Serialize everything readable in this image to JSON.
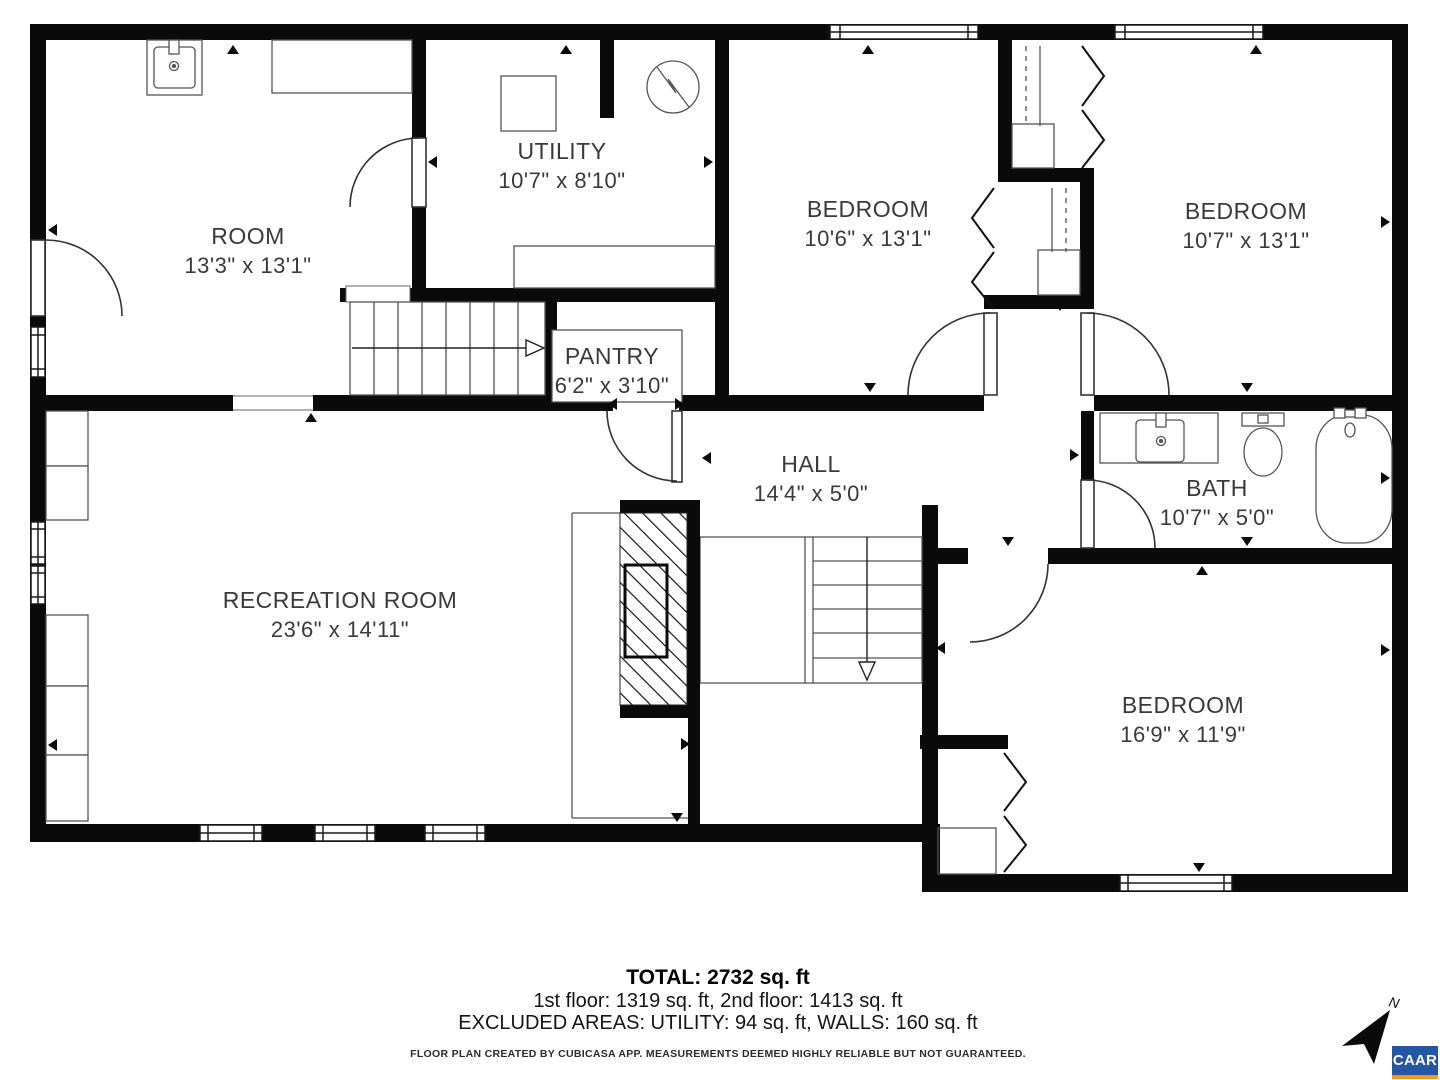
{
  "rooms": [
    {
      "name": "ROOM",
      "dims": "13'3\" x 13'1\""
    },
    {
      "name": "UTILITY",
      "dims": "10'7\" x 8'10\""
    },
    {
      "name": "BEDROOM",
      "dims": "10'6\" x 13'1\""
    },
    {
      "name": "BEDROOM",
      "dims": "10'7\" x 13'1\""
    },
    {
      "name": "PANTRY",
      "dims": "6'2\" x 3'10\""
    },
    {
      "name": "HALL",
      "dims": "14'4\" x 5'0\""
    },
    {
      "name": "BATH",
      "dims": "10'7\" x 5'0\""
    },
    {
      "name": "RECREATION ROOM",
      "dims": "23'6\" x 14'11\""
    },
    {
      "name": "BEDROOM",
      "dims": "16'9\" x 11'9\""
    }
  ],
  "footer": {
    "total": "TOTAL: 2732 sq. ft",
    "floors": "1st floor: 1319 sq. ft, 2nd floor: 1413 sq. ft",
    "excluded": "EXCLUDED AREAS: UTILITY: 94 sq. ft, WALLS: 160 sq. ft",
    "disclaimer": "FLOOR PLAN CREATED BY CUBICASA APP. MEASUREMENTS DEEMED HIGHLY RELIABLE BUT NOT GUARANTEED."
  },
  "compass": {
    "label": "N"
  },
  "branding": {
    "logo_text": "CAAR",
    "logo_bg": "#2456A4",
    "logo_bar": "#F7941D"
  }
}
